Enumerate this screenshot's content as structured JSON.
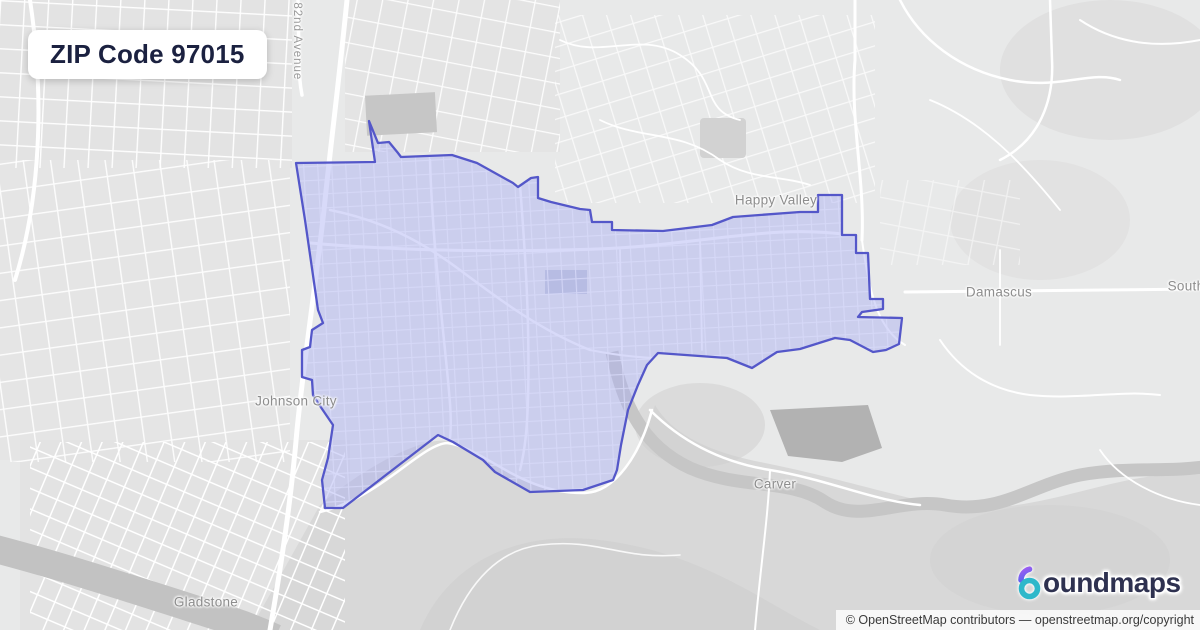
{
  "title_card": {
    "label": "ZIP Code 97015"
  },
  "map": {
    "place_labels": [
      {
        "id": "happy-valley",
        "text": "Happy Valley"
      },
      {
        "id": "damascus",
        "text": "Damascus"
      },
      {
        "id": "south-clipped",
        "text": "South"
      },
      {
        "id": "johnson-city",
        "text": "Johnson City"
      },
      {
        "id": "carver",
        "text": "Carver"
      },
      {
        "id": "gladstone",
        "text": "Gladstone"
      }
    ],
    "street_labels": [
      {
        "id": "82nd-avenue",
        "text": "t 82nd Avenue"
      }
    ],
    "boundary": {
      "zip": "97015",
      "stroke": "#5457c9",
      "fill": "rgba(168,172,242,0.45)",
      "points": "296,163 375,162 369,121 378,143 389,142 398,153 401,157 452,155 477,163 513,183 518,187 531,178 538,177 538,198 551,202 580,209 590,210 592,222 612,222 612,230 663,231 712,225 733,217 800,212 818,212 818,195 842,195 842,235 856,235 856,253 868,253 870,299 883,299 883,309 862,312 858,317 902,318 899,344 886,350 873,352 850,340 835,338 800,349 777,352 752,368 727,358 658,353 647,365 638,385 628,410 621,445 617,470 613,480 583,490 530,492 495,472 483,460 453,442 438,435 343,508 325,508 322,480 328,458 333,425 318,403 313,395 312,380 302,377 302,350 310,347 312,330 323,323 318,310 305,220"
    }
  },
  "branding": {
    "name": "boundmaps",
    "wordmark_rest": "oundmaps",
    "logo_colors": {
      "ring": "#2eb8ca",
      "hook_top": "#a05df2",
      "hook_bottom": "#5f63ee",
      "text": "#2e3150"
    }
  },
  "attribution": {
    "text": "© OpenStreetMap contributors — openstreetmap.org/copyright"
  }
}
